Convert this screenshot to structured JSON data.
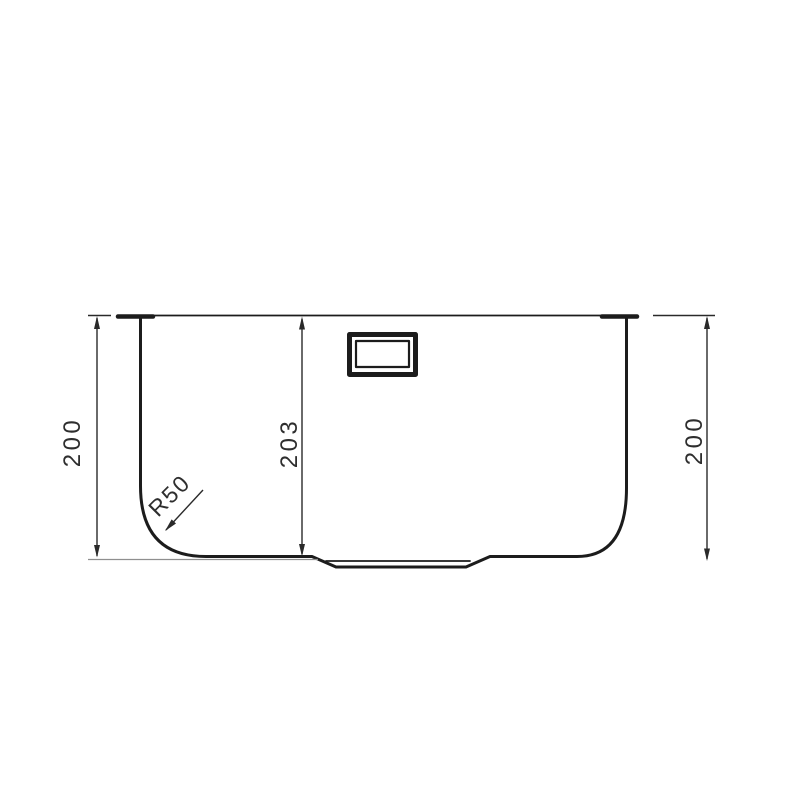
{
  "page": {
    "type": "technical-drawing",
    "subject": "Sink bowl front section view with dimensions",
    "background": "#ffffff"
  },
  "drawing": {
    "labels": {
      "left_height": "200",
      "center_depth": "203",
      "right_height": "200",
      "corner_radius": "R50"
    },
    "colors": {
      "outline": "#1c1c1c",
      "dimension": "#2a2a2a",
      "extension": "#8f8f8f",
      "text": "#2e2e2e"
    }
  }
}
